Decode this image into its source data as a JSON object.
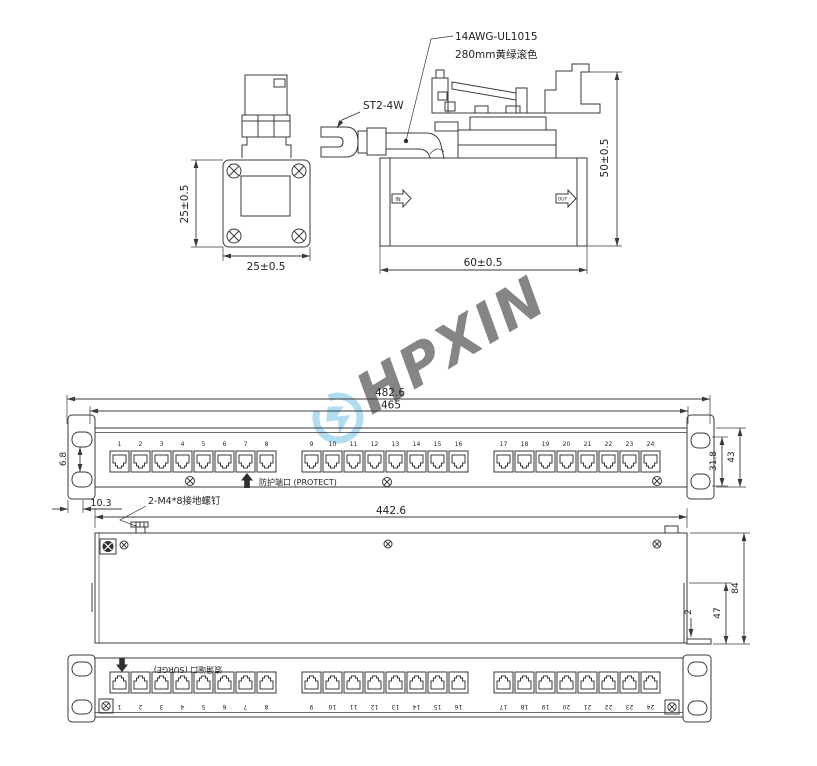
{
  "watermark": {
    "text": "HPXIN",
    "color": "#72c2e6"
  },
  "connector_front_view": {
    "width_dim": "25±0.5",
    "height_dim": "25±0.5"
  },
  "connector_side_view": {
    "cable_spec_line1": "14AWG-UL1015",
    "cable_spec_line2": "280mm黄绿滚色",
    "terminal_label": "ST2-4W",
    "in_marking": "IN",
    "out_marking": "OUT",
    "width_dim": "60±0.5",
    "height_dim": "50±0.5"
  },
  "panel_front_view": {
    "overall_width_dim": "482.6",
    "mounting_width_dim": "465",
    "ear_slot_dim": "6.8",
    "ear_offset_dim": "10.3",
    "slot_spacing_dim": "31.8",
    "height_dim": "43",
    "protect_port_label": "防护端口 (PROTECT)",
    "ground_screw_note": "2-M4*8接地螺钉",
    "port_numbers": [
      "1",
      "2",
      "3",
      "4",
      "5",
      "6",
      "7",
      "8",
      "9",
      "10",
      "11",
      "12",
      "13",
      "14",
      "15",
      "16",
      "17",
      "18",
      "19",
      "20",
      "21",
      "22",
      "23",
      "24"
    ]
  },
  "panel_top_view": {
    "width_dim": "442.6",
    "depth_dim": "84",
    "rear_height_dim": "47",
    "flange_thickness_dim": "2"
  },
  "panel_rear_view": {
    "surge_port_label": "浪涌端口 (SURGE)",
    "port_numbers": [
      "1",
      "2",
      "3",
      "4",
      "5",
      "6",
      "7",
      "8",
      "9",
      "10",
      "11",
      "12",
      "13",
      "14",
      "15",
      "16",
      "17",
      "18",
      "19",
      "20",
      "21",
      "22",
      "23",
      "24"
    ]
  }
}
